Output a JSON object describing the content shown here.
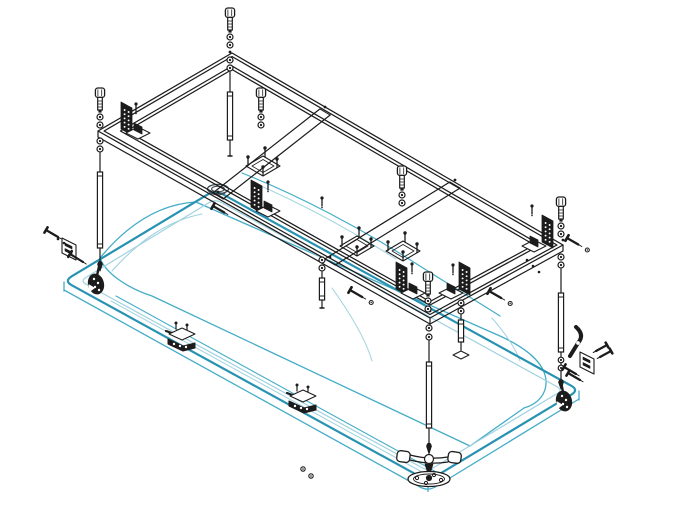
{
  "canvas": {
    "width": 674,
    "height": 522,
    "background": "#ffffff"
  },
  "palette": {
    "line": "#1c1c1c",
    "dark_fill": "#1c1c1c",
    "white": "#ffffff",
    "tub_main": "#45acc7",
    "tub_dark": "#2892b2",
    "tub_light": "#9fd2e0",
    "drain": "#3c4a52"
  },
  "diagram": {
    "name": "bathtub-support-frame-exploded-assembly",
    "type": "isometric-exploded-view"
  },
  "tub": {
    "name": "bathtub-outline",
    "rim_outer": [
      [
        64,
        281
      ],
      [
        215,
        190
      ],
      [
        579,
        390
      ],
      [
        428,
        481
      ]
    ],
    "rim_inner": [
      [
        80,
        281
      ],
      [
        215,
        199
      ],
      [
        563,
        390
      ],
      [
        428,
        471
      ]
    ],
    "rim_thickness": 9,
    "thickness_path": "M 64 290 L 420 487 Q 428 491.5 436 486.5 L 579 399",
    "corner_verticals": [
      [
        64,
        282,
        64,
        291
      ],
      [
        428,
        482.5,
        428,
        491.5
      ],
      [
        579,
        391,
        579,
        400
      ]
    ],
    "basin_paths": [
      "M 100 258 C 128 224 160 204 196 202 L 500 336 C 526 348 544 362 546 380 C 547 394 538 404 524 408 L 470 446 L 152 296 C 128 288 106 274 100 258",
      "M 112 271 C 138 242 166 221 202 214",
      "M 242 173 C 300 196 360 228 412 261 C 448 284 478 302 500 316",
      "M 254 183 C 305 205 352 231 396 259",
      "M 116 296 L 438 473",
      "M 111 301 L 433 478",
      "M 332 288 C 352 316 366 340 372 361",
      "M 492 318 C 505 333 515 347 520 361"
    ],
    "drain_center": [
      218,
      189
    ]
  },
  "frame": {
    "name": "support-frame",
    "outer": [
      [
        232,
        53
      ],
      [
        563,
        245
      ],
      [
        430,
        318
      ],
      [
        98,
        131
      ]
    ],
    "insets": [
      0,
      3.5,
      13,
      16.5
    ],
    "thickness": 6,
    "crossbars": [
      {
        "back": [
          325,
          112
        ],
        "front": [
          218,
          196
        ]
      },
      {
        "back": [
          455,
          185
        ],
        "front": [
          330,
          262
        ]
      }
    ],
    "junction_dots": [
      [
        230,
        52
      ],
      [
        325,
        107
      ],
      [
        455,
        180
      ],
      [
        218,
        192
      ],
      [
        330,
        257
      ],
      [
        430,
        311
      ],
      [
        563,
        240
      ],
      [
        98,
        126
      ]
    ]
  },
  "hardware": {
    "bolts": {
      "name": "socket-head-bolt",
      "items": [
        [
          230,
          8
        ],
        [
          100,
          88
        ],
        [
          261,
          88
        ],
        [
          402,
          166
        ],
        [
          561,
          197
        ],
        [
          428,
          272
        ]
      ]
    },
    "square_plates": {
      "name": "adjuster-plate",
      "items": [
        [
          263,
          166
        ],
        [
          357,
          246
        ],
        [
          403,
          251
        ]
      ]
    },
    "hole_plates": {
      "name": "mounting-bracket-plate",
      "items": [
        {
          "x": 121,
          "y": 102,
          "flip": false
        },
        {
          "x": 251,
          "y": 180,
          "flip": false
        },
        {
          "x": 542,
          "y": 215,
          "flip": true
        },
        {
          "x": 396,
          "y": 262,
          "flip": false
        },
        {
          "x": 459,
          "y": 262,
          "flip": true
        }
      ]
    },
    "small_screws": {
      "name": "grub-screw",
      "items": [
        [
          136,
          104
        ],
        [
          268,
          182
        ],
        [
          412,
          264
        ],
        [
          453,
          265
        ],
        [
          532,
          206
        ],
        [
          322,
          198
        ]
      ]
    },
    "legs": {
      "name": "adjustable-leg",
      "items": [
        {
          "x": 230,
          "top": 58,
          "bottom": 156,
          "washers": [
            60,
            68
          ],
          "sleeve": [
            92,
            140
          ],
          "tip": "plain"
        },
        {
          "x": 100,
          "top": 139,
          "bottom": 262,
          "washers": [
            141,
            149
          ],
          "sleeve": [
            172,
            248
          ],
          "tip": "arrow"
        },
        {
          "x": 561,
          "top": 255,
          "bottom": 380,
          "washers": [
            257,
            265
          ],
          "sleeve": [
            293,
            352
          ],
          "washers2": [
            360,
            368
          ],
          "tip": "arrow"
        },
        {
          "x": 429,
          "top": 326,
          "bottom": 444,
          "washers": [
            328,
            337
          ],
          "sleeve": [
            362,
            428
          ],
          "tip": "dart"
        },
        {
          "x": 322,
          "top": 258,
          "bottom": 308,
          "washers": [
            260,
            268
          ],
          "sleeve": [
            278,
            300
          ],
          "tip": "plain"
        },
        {
          "x": 461,
          "top": 301,
          "bottom": 350,
          "washers": [
            303,
            311
          ],
          "sleeve": [
            320,
            342
          ],
          "tip": "pad"
        }
      ]
    },
    "clips": {
      "name": "rim-clip",
      "items": [
        [
          181,
          338
        ],
        [
          302,
          400
        ]
      ]
    },
    "corner_feet": {
      "name": "corner-foot",
      "items": [
        {
          "x": 96,
          "y": 284,
          "px": 100,
          "py": 262
        },
        {
          "x": 564,
          "y": 401,
          "px": 561,
          "py": 382
        }
      ]
    },
    "wall_brackets": {
      "name": "wall-anchor-bracket",
      "items": [
        {
          "x": 62,
          "y": 238,
          "side": "l"
        },
        {
          "x": 580,
          "y": 352,
          "side": "r"
        }
      ]
    },
    "hook_arm": {
      "name": "clamp-lever",
      "pos": [
        576,
        341
      ]
    },
    "diag_screws": {
      "name": "anchor-screw",
      "items": [
        {
          "x": 213,
          "y": 206,
          "len": 13,
          "dot": false
        },
        {
          "x": 350,
          "y": 290,
          "len": 14,
          "dot": true
        },
        {
          "x": 489,
          "y": 291,
          "len": 14,
          "dot": true
        },
        {
          "x": 567,
          "y": 238,
          "len": 13,
          "dot": true
        }
      ]
    },
    "dot_trio": [
      [
        527,
        260
      ],
      [
        533,
        266
      ],
      [
        539,
        272
      ]
    ],
    "floor_dots": [
      [
        303,
        469
      ],
      [
        311,
        476
      ]
    ],
    "t_foot": {
      "name": "t-handle-foot",
      "pos": [
        429,
        458
      ]
    }
  }
}
